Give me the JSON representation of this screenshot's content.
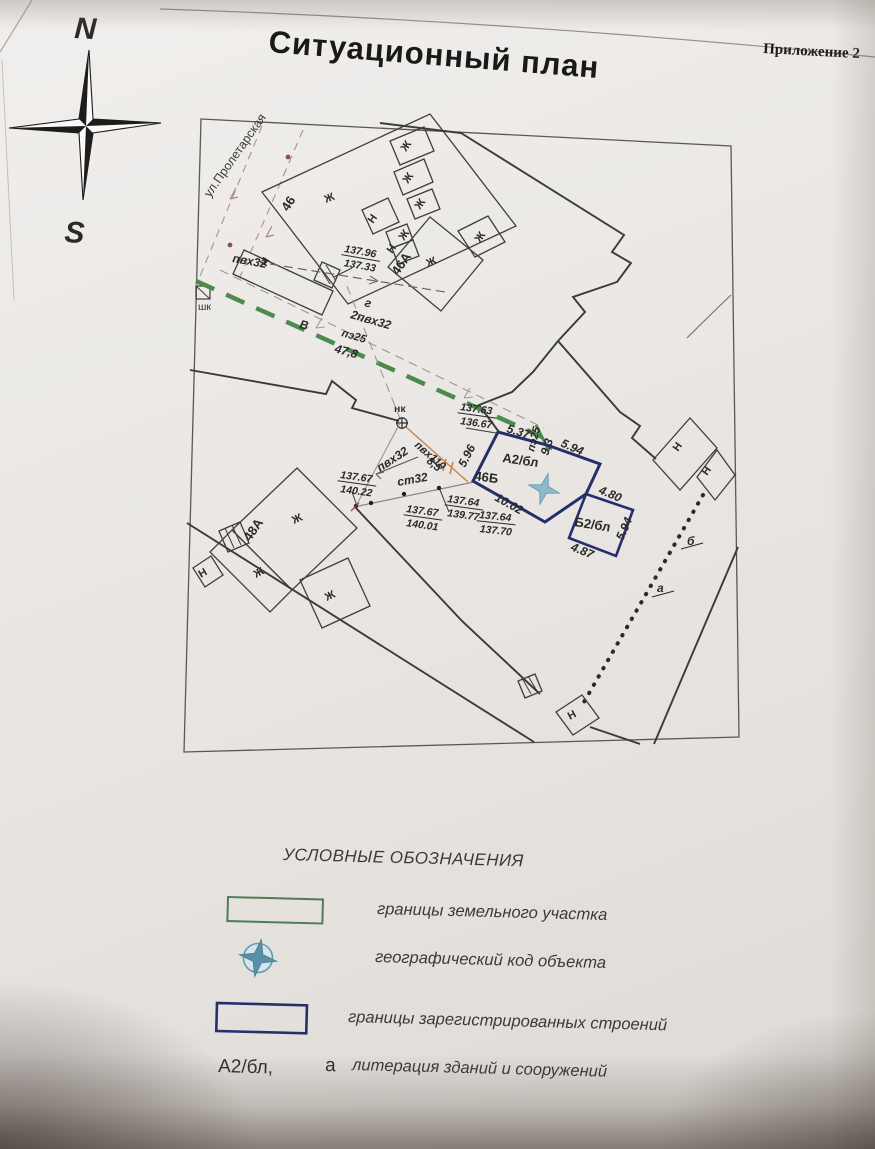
{
  "page": {
    "title": "Ситуационный план",
    "annex": "Приложение 2"
  },
  "compass": {
    "north": "N",
    "south": "S"
  },
  "map": {
    "street": "ул.Пролетарская",
    "letters": {
      "zh": "Ж",
      "n": "Н"
    },
    "buildings": {
      "b46": "46",
      "b46a": "46А",
      "b46b": "46Б",
      "b48a": "48А"
    },
    "marks": {
      "shk": "шк",
      "nk": "нк",
      "v": "В",
      "g": "г",
      "lit_b": "б",
      "lit_a": "а",
      "a2bl": "А2/бл",
      "b2bl": "Б2/бл"
    },
    "pipes": {
      "pvh32": "пвх32",
      "two_pvh32": "2пвх32",
      "pe25": "пэ25",
      "len_478": "47,8",
      "pvh110": "пвх110",
      "len_85": "8,5",
      "st32": "ст32",
      "len_93": "9,3"
    },
    "dims": {
      "d_537": "5.37",
      "d_594": "5.94",
      "d_596": "5.96",
      "d_1002": "10.02",
      "d_480": "4.80",
      "d_487": "4.87",
      "d_594b": "5.94"
    },
    "elevations": {
      "e1": {
        "top": "137.96",
        "bottom": "137.33"
      },
      "e2": {
        "top": "137.63",
        "bottom": "136.67"
      },
      "e3": {
        "top": "137.67",
        "bottom": "140.22"
      },
      "e4": {
        "top": "137.67",
        "bottom": "140.01"
      },
      "e5": {
        "top": "137.64",
        "bottom": "139.77"
      },
      "e6": {
        "top": "137.64",
        "bottom": "137.70"
      }
    }
  },
  "legend": {
    "title": "УСЛОВНЫЕ ОБОЗНАЧЕНИЯ",
    "items": [
      {
        "symbol": "parcel-boundary-swatch",
        "label": "границы земельного участка"
      },
      {
        "symbol": "geo-code-symbol",
        "label": "географический код объекта"
      },
      {
        "symbol": "registered-buildings-swatch",
        "label": "границы зарегистрированных строений"
      },
      {
        "symbol": "litera-sample",
        "prefix": "А2/бл,",
        "prefix2": "а",
        "label": "литерация зданий и сооружений"
      }
    ]
  },
  "colors": {
    "pipe_green": "#4d8b4d",
    "building_blue": "#242f6b",
    "geo_star": "#8cb8cb",
    "geo_star_legend": "#5890aa",
    "legend_green": "#4e7d57",
    "north": "#2e3c8e",
    "south": "#b64562"
  }
}
